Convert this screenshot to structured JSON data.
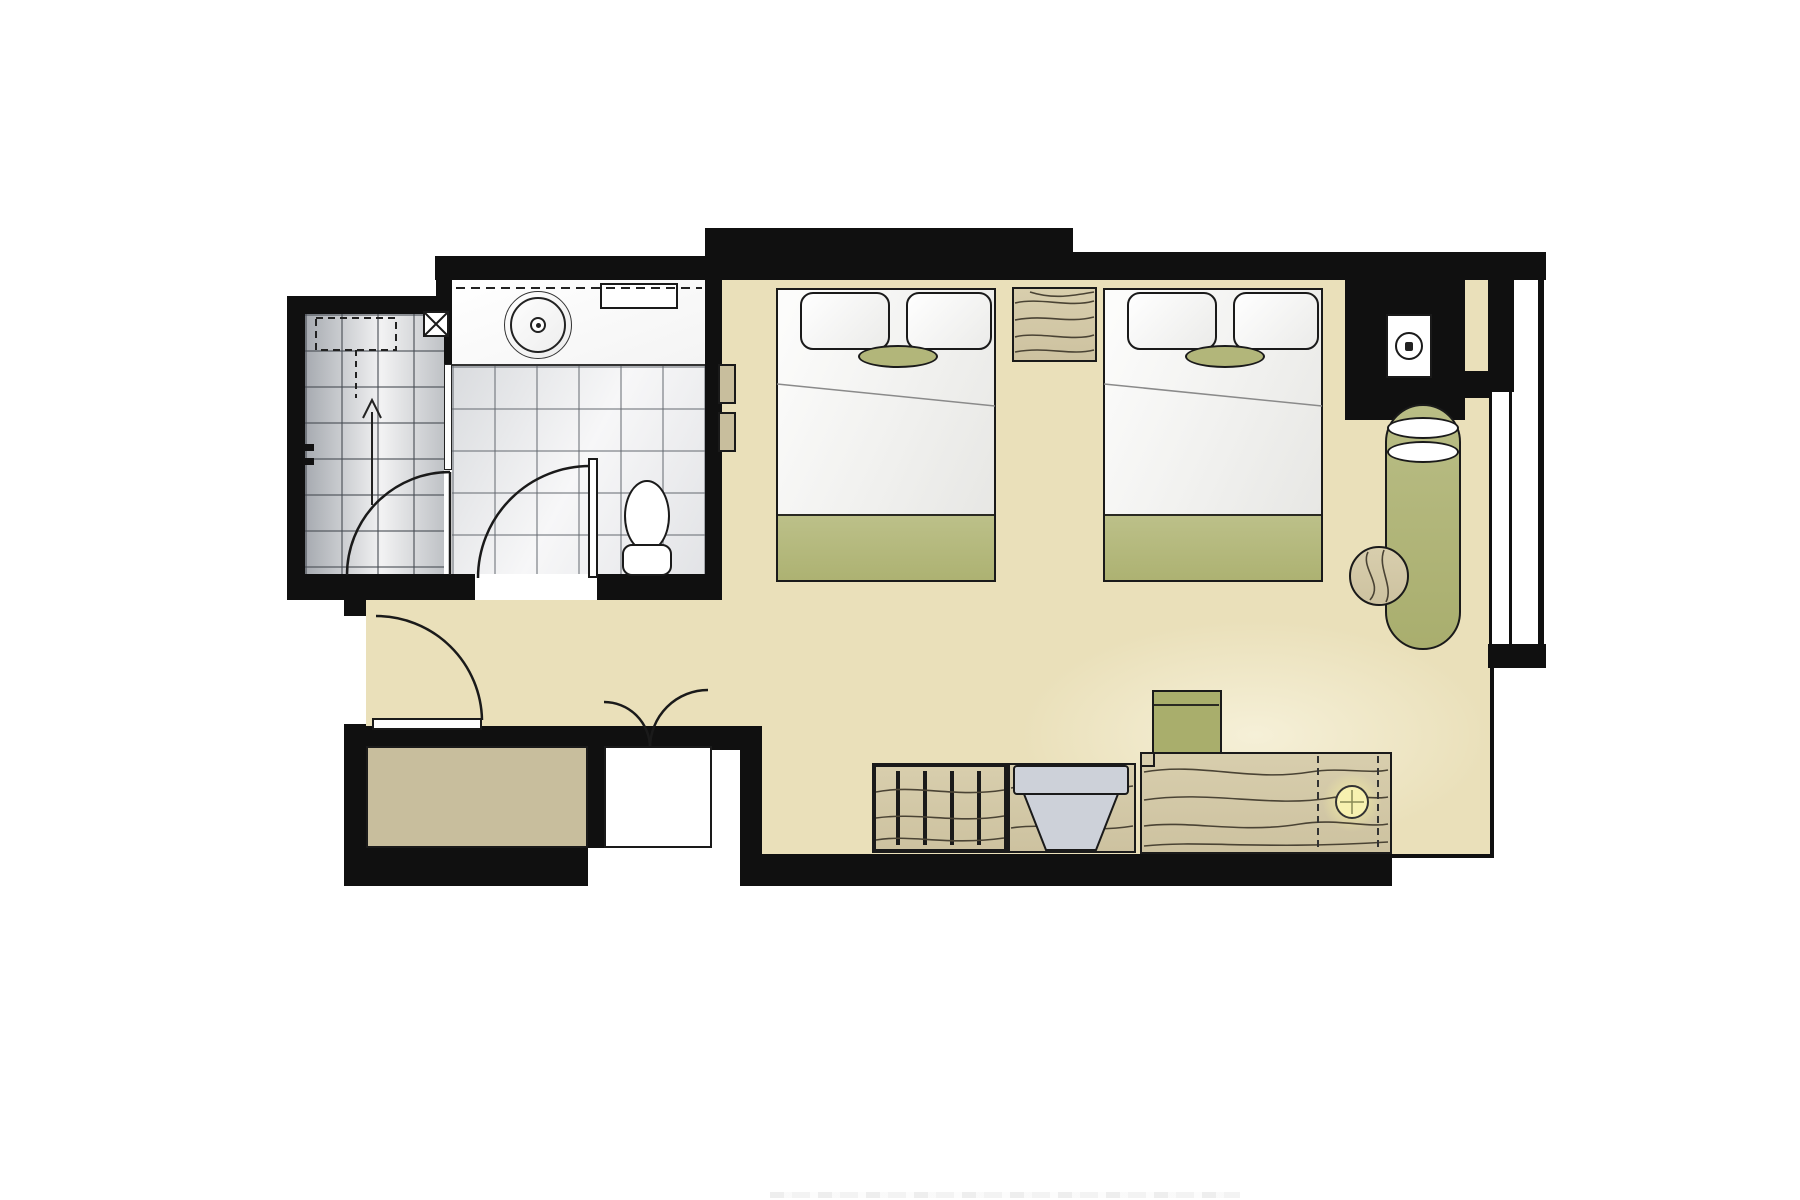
{
  "page": {
    "type": "architectural-floor-plan",
    "subject": "Hotel guest room plan: two beds, bathroom with shower, entry, desk and chaise by window"
  },
  "palette": {
    "wall": "#101010",
    "floor": "#eae0ba",
    "wood": "#cdc2a0",
    "woodLight": "#d8cead",
    "grain": "#4a4334",
    "olive": "#b2b67a",
    "oliveDeep": "#a9ae6c",
    "tan": "#c8be9d",
    "chairGray": "#cdd1d9",
    "lamp": "#f7f1b0",
    "lineDark": "#1a1a1a",
    "foldGray": "#8a8a8a",
    "white": "#ffffff"
  },
  "elements": {
    "bed1": "Bed 1",
    "bed2": "Bed 2",
    "nightstand": "Nightstand",
    "chaise": "Chaise longue with two cushions",
    "sideTable": "Round side table",
    "desk": "Desk console with minibar",
    "stool": "Desk stool",
    "deskChair": "Desk chair",
    "luggageRack": "Luggage bench",
    "wardrobeTan": "Entry closet",
    "wardrobeWhite": "Closet with double doors",
    "toilet": "Toilet",
    "washbasin": "Round washbasin",
    "vanity": "Vanity counter",
    "mirror": "Mirror line",
    "shelf": "Towel shelf",
    "shower": "Shower room",
    "bathroom": "Bathroom",
    "entryDoor": "Entry door swing",
    "bathroomDoor": "Bathroom door swing",
    "showerDoor": "Shower door swing",
    "closetDoors": "Double closet door swings",
    "window": "Window wall",
    "serviceShaft": "Service shaft",
    "equipmentBox": "Wall-mounted unit",
    "lamp": "Desk lamp",
    "floorDrain": "Floor drain",
    "slopeArrow": "Floor slope arrow",
    "wallPanels": "Wall switch panels"
  }
}
